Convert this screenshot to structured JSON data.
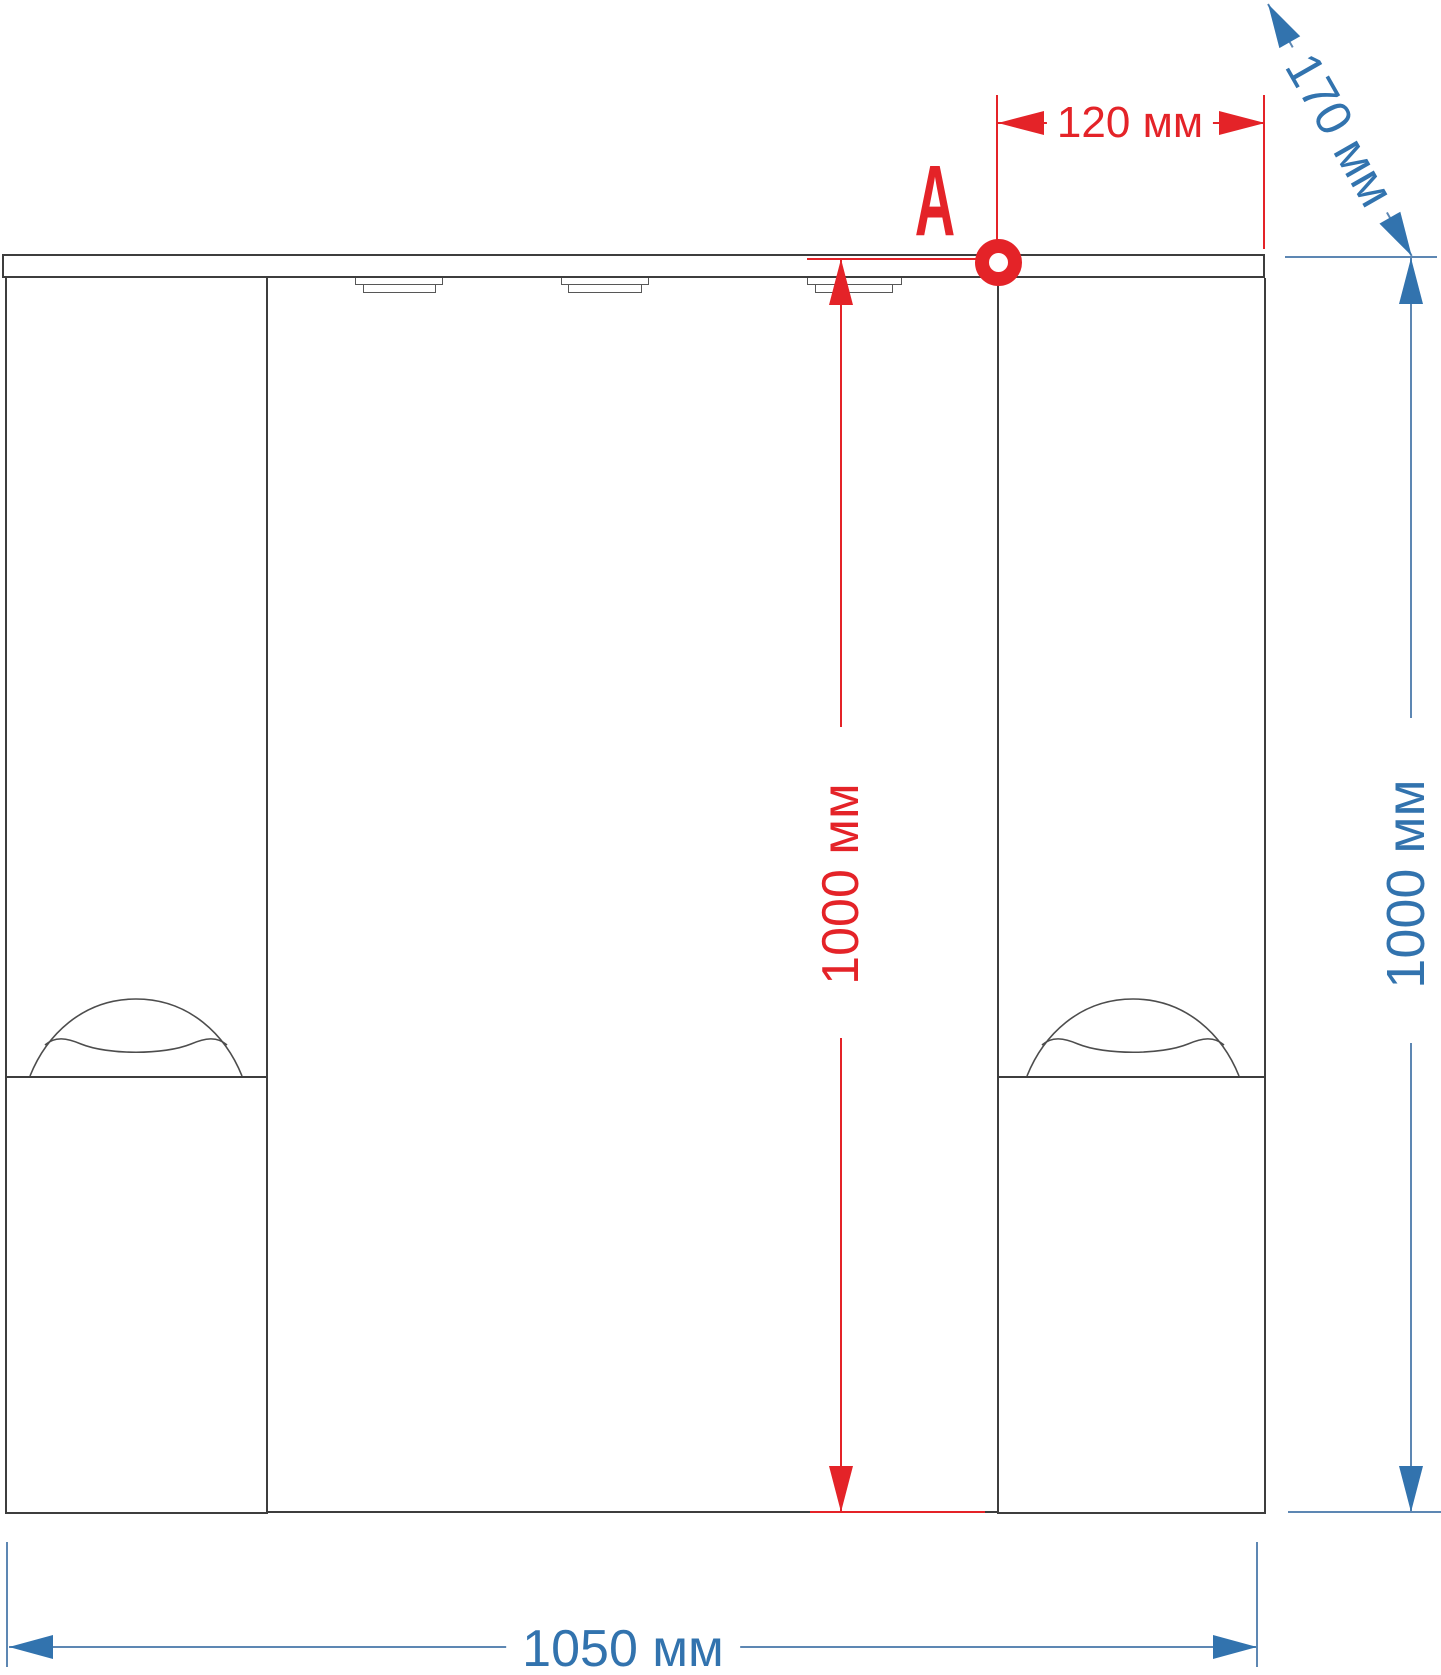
{
  "title": "Mirror cabinet mounting dimensions drawing",
  "annotations": {
    "point_label": "A"
  },
  "dimensions": {
    "hole_offset": {
      "label": "120 мм",
      "color": "#e42328"
    },
    "hole_height": {
      "label": "1000 мм",
      "color": "#e42328"
    },
    "depth": {
      "label": "170 мм",
      "color": "#3273ae"
    },
    "overall_height": {
      "label": "1000 мм",
      "color": "#3273ae"
    },
    "overall_width": {
      "label": "1050 мм",
      "color": "#3273ae"
    }
  },
  "colors": {
    "red_annotation": "#e42328",
    "blue_annotation": "#3273ae",
    "blue_line": "#5d87b3",
    "outline": "#3d3d3d",
    "detail_line": "#575757"
  }
}
